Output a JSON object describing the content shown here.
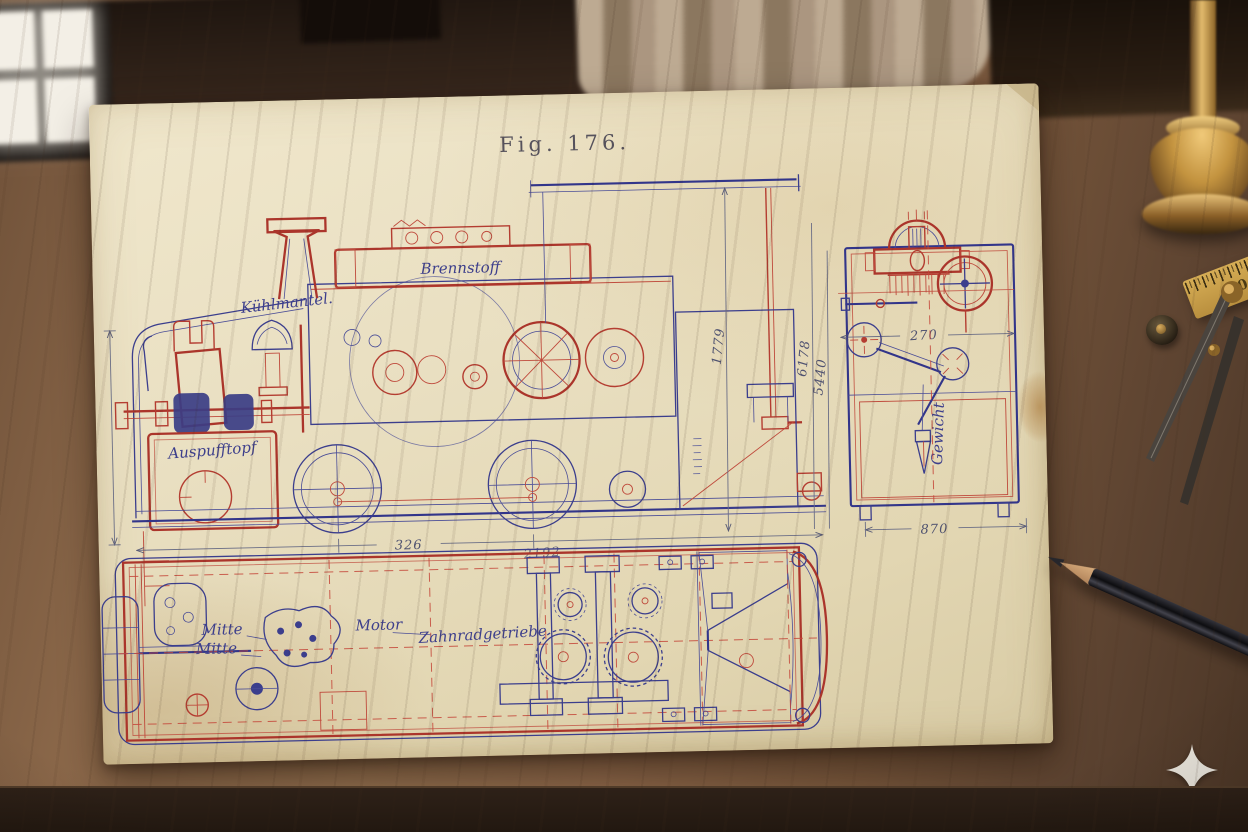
{
  "figure": {
    "title": "Fig. 176.",
    "side_view": {
      "label_boiler": "Kühlmantel.",
      "label_fuel_tank": "Brennstoff",
      "label_exhaust": "Auspufftopf",
      "dim_length": "326",
      "dim_length_alt": "2192",
      "dim_height": "1779",
      "dim_height_a": "6178",
      "dim_height_b": "5440"
    },
    "end_view": {
      "dim_gauge": "270",
      "dim_width": "870",
      "label_plumb": "Gewicht"
    },
    "plan_view": {
      "label_centerline_1": "Mitte",
      "label_centerline_2": "Mitte",
      "label_motor": "Motor",
      "label_gearbox": "Zahnradgetriebe"
    }
  },
  "desk": {
    "ruler_mark": "10"
  },
  "colors": {
    "ink_blue": "#3b3e8d",
    "ink_red": "#b43d31",
    "paper": "#e9dfc1",
    "wood": "#7c5a3e",
    "brass": "#c49a4e"
  }
}
